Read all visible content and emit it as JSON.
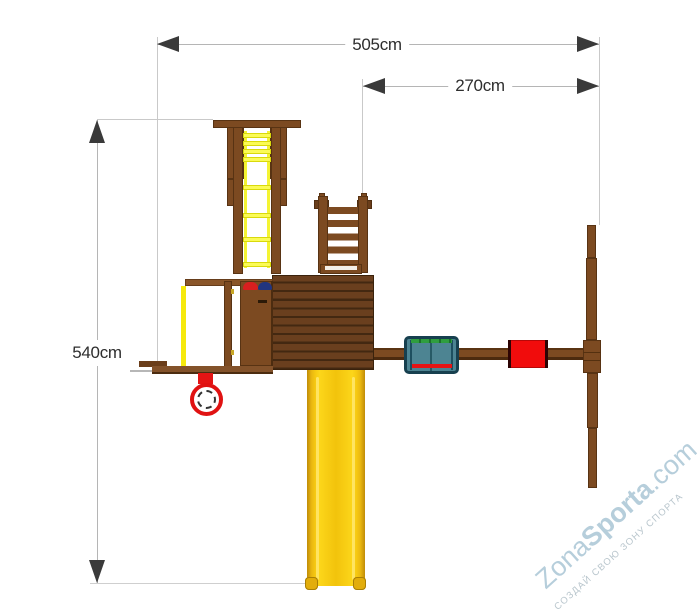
{
  "dimensions": {
    "total_width": "505cm",
    "swing_width": "270cm",
    "total_depth": "540cm"
  },
  "watermark": {
    "brand_zona": "Zona",
    "brand_sporta": "Sporta",
    "brand_domain": ".com",
    "tagline": "СОЗДАЙ СВОЮ ЗОНУ СПОРТА"
  },
  "palette": {
    "wood": "#7c4a21",
    "wood_dark": "#432811",
    "ladder_yellow": "#fbfb55",
    "slide_yellow": "#f7ca12",
    "accent_red": "#e51414",
    "seat_teal": "#4d8492",
    "seat_green_stripe": "#2f9e3f",
    "seat_border_navy": "#17404f",
    "wheel_blue": "#22357f",
    "dimension_line": "#b5b5b5",
    "dimension_arrow": "#3a3a3a",
    "watermark_blue": "#b6cedb"
  }
}
